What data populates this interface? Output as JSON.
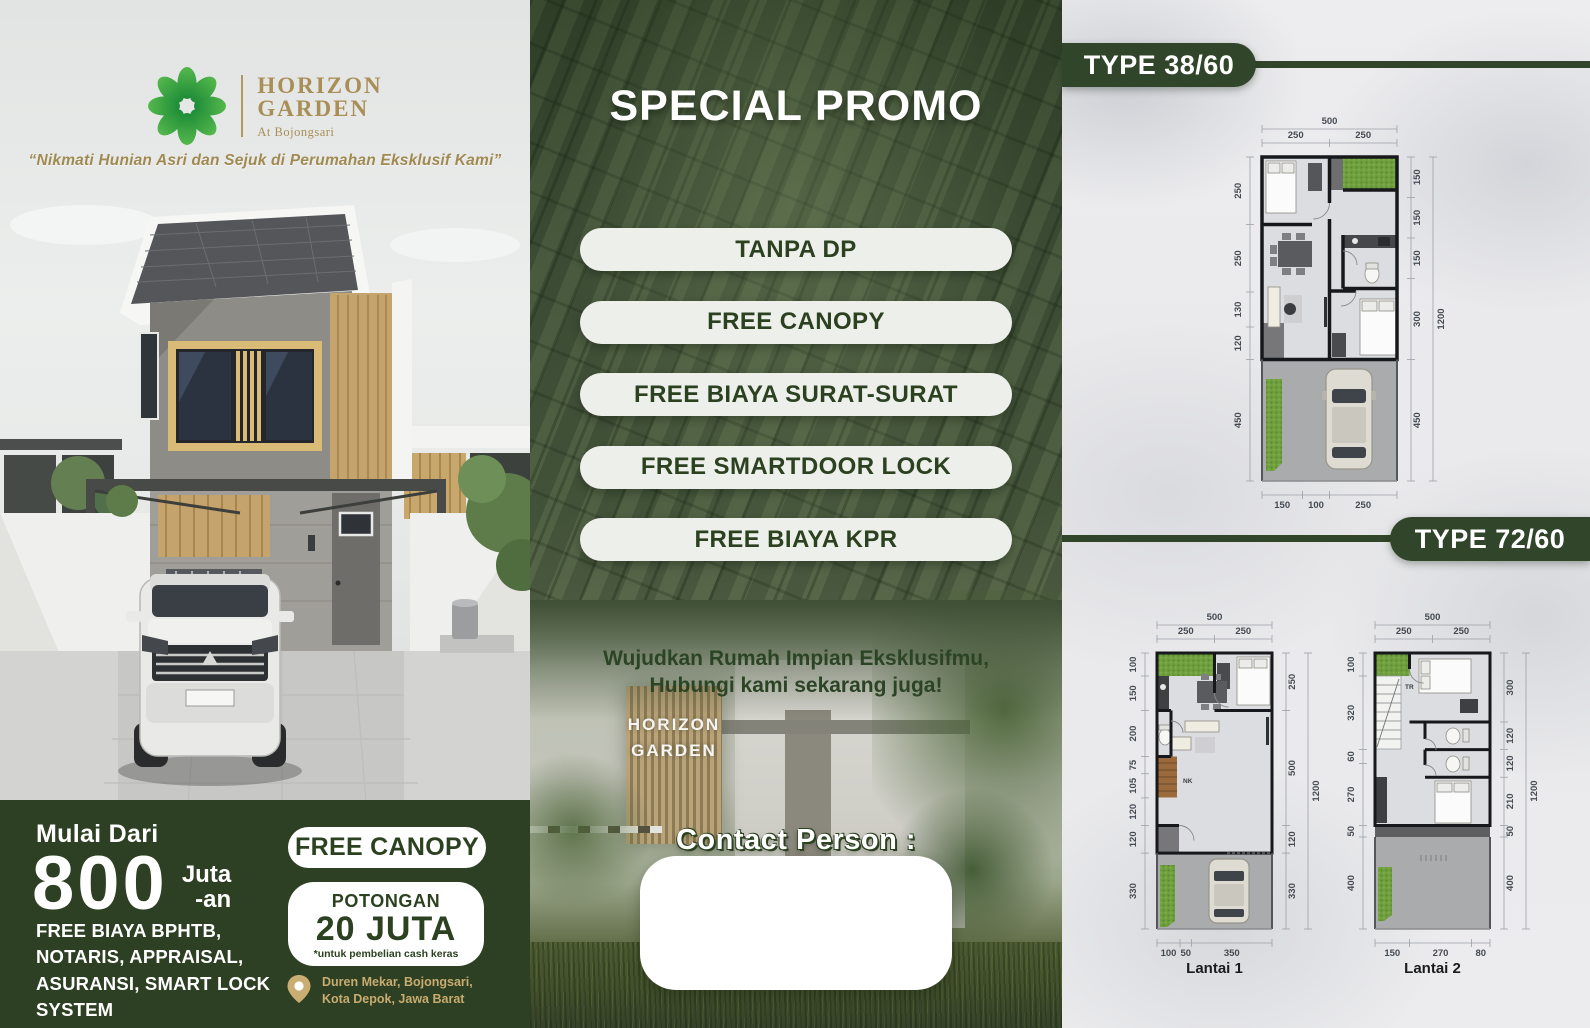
{
  "left": {
    "logo": {
      "line1": "HORIZON",
      "line2": "GARDEN",
      "sub": "At Bojongsari"
    },
    "tagline": "“Nikmati Hunian Asri dan Sejuk di Perumahan Eksklusif Kami”",
    "footer": {
      "price_prefix": "Mulai Dari",
      "price_value": "800",
      "unit_top": "Juta",
      "unit_bottom": "-an",
      "free_note": "FREE BIAYA BPHTB, NOTARIS, APPRAISAL, ASURANSI, SMART LOCK SYSTEM",
      "canopy": "FREE CANOPY",
      "potongan_label": "POTONGAN",
      "potongan_value": "20 JUTA",
      "potongan_note": "*untuk pembelian cash keras",
      "address1": "Duren Mekar, Bojongsari, Kota Depok,",
      "address2": "Jawa Barat"
    }
  },
  "middle": {
    "title": "SPECIAL PROMO",
    "pills": [
      "TANPA DP",
      "FREE CANOPY",
      "FREE BIAYA SURAT-SURAT",
      "FREE SMARTDOOR LOCK",
      "FREE BIAYA KPR"
    ],
    "cta1": "Wujudkan Rumah Impian Eksklusifmu,",
    "cta2": "Hubungi kami sekarang juga!",
    "contact_label": "Contact Person :",
    "sign1": "HORIZON",
    "sign2": "GARDEN"
  },
  "right": {
    "badge1": "TYPE 38/60",
    "badge2": "TYPE 72/60",
    "plan3860": {
      "top_total": "500",
      "top_dims": [
        "250",
        "250"
      ],
      "left_dims": [
        "250",
        "250",
        "130",
        "120",
        "450"
      ],
      "right_dims": [
        "150",
        "150",
        "150",
        "300",
        "450"
      ],
      "side_total": "1200",
      "bottom_dims": [
        "150",
        "100",
        "250"
      ]
    },
    "plan7260_l1": {
      "label": "Lantai 1",
      "stair": "NK",
      "top_total": "500",
      "top_dims": [
        "250",
        "250"
      ],
      "left_dims": [
        "100",
        "150",
        "200",
        "75",
        "105",
        "120",
        "120",
        "330"
      ],
      "right_dims": [
        "250",
        "500",
        "120",
        "330"
      ],
      "side_total": "1200",
      "bottom_dims": [
        "100",
        "50",
        "350"
      ]
    },
    "plan7260_l2": {
      "label": "Lantai 2",
      "stair": "TR",
      "top_total": "500",
      "top_dims": [
        "250",
        "250"
      ],
      "left_dims": [
        "100",
        "320",
        "60",
        "270",
        "50",
        "400"
      ],
      "right_dims": [
        "300",
        "120",
        "120",
        "210",
        "50",
        "400"
      ],
      "side_total": "1200",
      "bottom_dims": [
        "150",
        "270",
        "80"
      ]
    }
  },
  "colors": {
    "green_dark": "#2e4023",
    "green_badge": "#31452a",
    "green_panel": "#3b4b31",
    "pill_bg": "#edefeb",
    "gold": "#a98e55",
    "gold_light": "#c7ab6f"
  }
}
